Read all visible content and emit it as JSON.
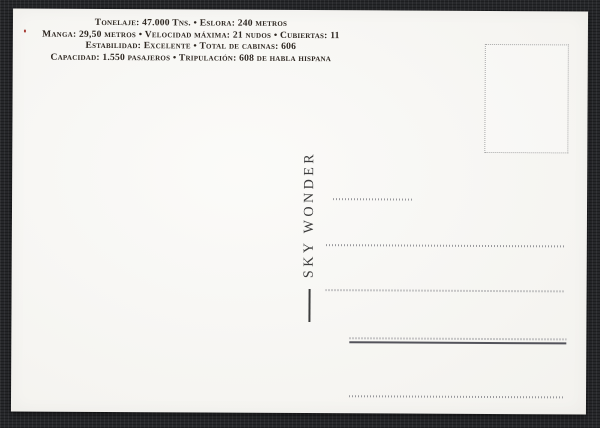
{
  "theme": {
    "bg": "#27282b",
    "card_bg": "#f7f6f2",
    "specs_text": "#2e2721",
    "ship_text": "#3d3d3d",
    "dotted_line": "#97979b",
    "solid_line": "#53535b",
    "stamp_border": "#a9a9a9"
  },
  "card": {
    "type": "postcard-back",
    "specs": {
      "lines": [
        "Tonelaje: 47.000 Tns. • Eslora: 240 metros",
        "Manga: 29,50 metros • Velocidad máxima: 21 nudos • Cubiertas: 11",
        "Estabilidad: Excelente • Total de cabinas: 606",
        "Capacidad: 1.550 pasajeros • Tripulación: 608 de habla hispana"
      ]
    },
    "ship_name": {
      "dash": "—",
      "text": "SKY WONDER",
      "orientation": "vertical-bottom-to-top"
    },
    "stamp_box": {
      "present": true,
      "border_style": "dotted"
    },
    "address_lines": {
      "count": 5,
      "note": "dotted rule lines; fourth line doubled with a solid dark rule"
    }
  }
}
